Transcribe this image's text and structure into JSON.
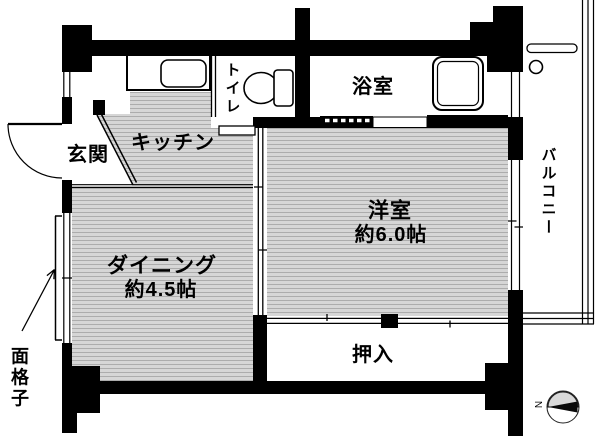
{
  "title": "1DK apartment floor plan",
  "colors": {
    "wall": "#000000",
    "background": "#ffffff",
    "floor_fill": "#d6d6d6",
    "floor_line": "#acacac",
    "text": "#000000",
    "compass_fill": "#d9d9d9"
  },
  "rooms": {
    "entrance": {
      "label": "玄関"
    },
    "kitchen": {
      "label": "キッチン"
    },
    "toilet": {
      "label": "トイレ"
    },
    "bath": {
      "label": "浴室"
    },
    "western_room": {
      "label": "洋室",
      "size": "約6.0帖"
    },
    "dining": {
      "label": "ダイニング",
      "size": "約4.5帖"
    },
    "closet": {
      "label": "押入"
    },
    "balcony": {
      "label": "バルコニー"
    }
  },
  "annotations": {
    "window_grate": {
      "label": "面格子"
    },
    "compass": {
      "label": "N"
    }
  },
  "fixtures": [
    "kitchen-sink",
    "toilet-bowl",
    "bathtub",
    "balcony-faucet",
    "entrance-door",
    "toilet-door",
    "bath-folding-door",
    "sliding-door",
    "closet-sliding-door",
    "window-grate",
    "compass-north-arrow"
  ]
}
